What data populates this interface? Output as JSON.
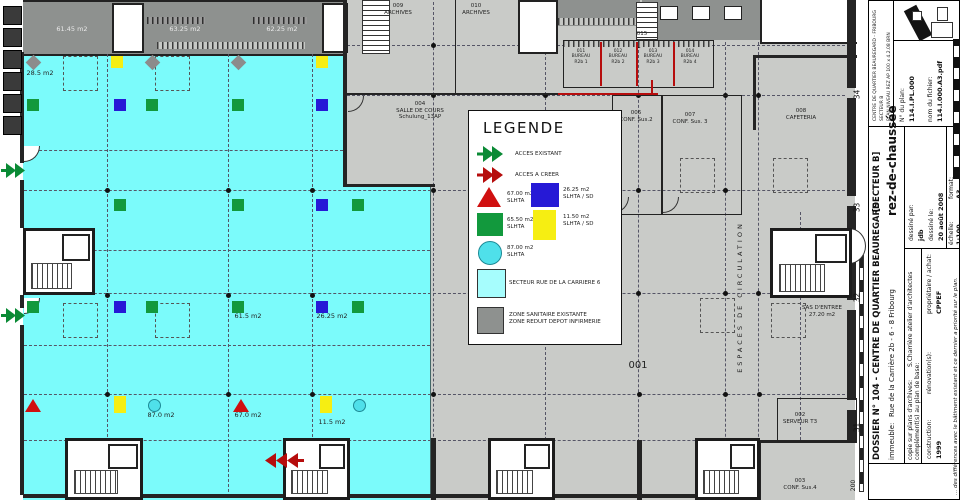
{
  "colors": {
    "floor_gray": "#c9cbc8",
    "zone_gray": "#8e918f",
    "sector_cyan": "#7bfbfb",
    "sector_legend": "#a6fdfd",
    "marker_green": "#12993d",
    "marker_blue": "#2619d6",
    "marker_yellow": "#f6ee12",
    "marker_red": "#d01010",
    "marker_cyan": "#4fe0ea",
    "acces_existant_green": "#0a8a35",
    "acces_creer_red": "#b60d0d"
  },
  "legend": {
    "title": "LEGENDE",
    "acces_existant": "ACCES EXISTANT",
    "acces_creer": "ACCES A CREER",
    "tri_l": "67.00 m2\nSLHTA",
    "blue_l": "26.25 m2\nSLHTA / SD",
    "green_l": "65.50 m2\nSLHTA",
    "yellow_l": "11.50 m2\nSLHTA / SD",
    "circle_l": "87.00 m2\nSLHTA",
    "sector_l": "SECTEUR RUE DE LA CARRIERE 6",
    "sanitaire_l": "ZON​E SANITAIRE EXISTANTE\nZONE REDUIT DEPOT INFIRMERIE"
  },
  "plan": {
    "labels": [
      {
        "text": "61.45 m2",
        "x": 72,
        "y": 26,
        "cls": "lt"
      },
      {
        "text": "63.25 m2",
        "x": 185,
        "y": 26,
        "cls": "lt"
      },
      {
        "text": "62.25 m2",
        "x": 282,
        "y": 26,
        "cls": "lt"
      },
      {
        "text": "28.5 m2",
        "x": 40,
        "y": 70,
        "cls": "sm"
      },
      {
        "text": "009\nARCHIVES",
        "x": 398,
        "y": 3,
        "cls": "xs"
      },
      {
        "text": "010\nARCHIVES",
        "x": 476,
        "y": 3,
        "cls": "xs"
      },
      {
        "text": "004\nSALLE DE COURS\nSchulung_13AP",
        "x": 420,
        "y": 101,
        "cls": "xs"
      },
      {
        "text": "015",
        "x": 642,
        "y": 31,
        "cls": "xs"
      },
      {
        "text": "011\nBUREAU\nR2b 1",
        "x": 581,
        "y": 49,
        "cls": "xxs"
      },
      {
        "text": "012\nBUREAU\nR2b 2",
        "x": 618,
        "y": 49,
        "cls": "xxs"
      },
      {
        "text": "013\nBUREAU\nR2b 3",
        "x": 653,
        "y": 49,
        "cls": "xxs"
      },
      {
        "text": "014\nBUREAU\nR2b 4",
        "x": 690,
        "y": 49,
        "cls": "xxs"
      },
      {
        "text": "006\nCONF. Sus.2",
        "x": 636,
        "y": 110,
        "cls": "xs"
      },
      {
        "text": "007\nCONF. Sus. 3",
        "x": 690,
        "y": 112,
        "cls": "xs"
      },
      {
        "text": "008\nCAFETERIA",
        "x": 801,
        "y": 108,
        "cls": "xs"
      },
      {
        "text": "001",
        "x": 638,
        "y": 360,
        "cls": "md"
      },
      {
        "text": "61.5 m2",
        "x": 248,
        "y": 313,
        "cls": "sm"
      },
      {
        "text": "26.25 m2",
        "x": 332,
        "y": 313,
        "cls": "sm"
      },
      {
        "text": "87.0 m2",
        "x": 161,
        "y": 412,
        "cls": "sm"
      },
      {
        "text": "67.0 m2",
        "x": 248,
        "y": 412,
        "cls": "sm"
      },
      {
        "text": "11.5 m2",
        "x": 332,
        "y": 419,
        "cls": "sm"
      },
      {
        "text": "SAS D'ENTREE\n27.20 m2",
        "x": 822,
        "y": 305,
        "cls": "xs"
      },
      {
        "text": "002\nSERVEUR T3",
        "x": 800,
        "y": 412,
        "cls": "xs"
      },
      {
        "text": "003\nCONF. Sus.4",
        "x": 800,
        "y": 478,
        "cls": "xs"
      },
      {
        "text": "ESPACES DE CIRCULATION",
        "x": 741,
        "y": 297,
        "cls": "vert"
      }
    ],
    "markers": [
      {
        "s": "d",
        "x": 33,
        "y": 62
      },
      {
        "s": "y",
        "x": 117,
        "y": 62
      },
      {
        "s": "d",
        "x": 152,
        "y": 62
      },
      {
        "s": "d",
        "x": 238,
        "y": 62
      },
      {
        "s": "y",
        "x": 322,
        "y": 62
      },
      {
        "s": "g",
        "x": 33,
        "y": 105
      },
      {
        "s": "b",
        "x": 120,
        "y": 105
      },
      {
        "s": "g",
        "x": 152,
        "y": 105
      },
      {
        "s": "g",
        "x": 238,
        "y": 105
      },
      {
        "s": "b",
        "x": 322,
        "y": 105
      },
      {
        "s": "g",
        "x": 120,
        "y": 205
      },
      {
        "s": "g",
        "x": 238,
        "y": 205
      },
      {
        "s": "b",
        "x": 322,
        "y": 205
      },
      {
        "s": "g",
        "x": 358,
        "y": 205
      },
      {
        "s": "g",
        "x": 33,
        "y": 307
      },
      {
        "s": "b",
        "x": 120,
        "y": 307
      },
      {
        "s": "g",
        "x": 152,
        "y": 307
      },
      {
        "s": "g",
        "x": 238,
        "y": 307
      },
      {
        "s": "b",
        "x": 322,
        "y": 307
      },
      {
        "s": "g",
        "x": 358,
        "y": 307
      },
      {
        "s": "t",
        "x": 33,
        "y": 405
      },
      {
        "s": "y2",
        "x": 120,
        "y": 405
      },
      {
        "s": "c",
        "x": 154,
        "y": 405
      },
      {
        "s": "t",
        "x": 241,
        "y": 405
      },
      {
        "s": "y2",
        "x": 326,
        "y": 405
      },
      {
        "s": "c",
        "x": 359,
        "y": 405
      }
    ],
    "arrows": [
      {
        "type": "acces-existant",
        "x": 1,
        "y": 162,
        "dir": "right"
      },
      {
        "type": "acces-existant",
        "x": 1,
        "y": 307,
        "dir": "right"
      },
      {
        "type": "acces-a-creer",
        "x": 264,
        "y": 452,
        "dir": "left"
      }
    ],
    "grid_labels": [
      {
        "label": "34",
        "y": 90
      },
      {
        "label": "33",
        "y": 203
      },
      {
        "label": "32",
        "y": 293
      },
      {
        "label": "31",
        "y": 423
      }
    ]
  },
  "title_block": {
    "project_lines": [
      "CENTRE DE QUARTIER BEAUREGARD - FRIBOURG",
      "SECTEUR B",
      "PLAN NIVEAU REZ AP    100 x 4.2.08 BRN"
    ],
    "dossier": "DOSSIER N°  104 - CENTRE DE QUARTIER BEAUREGARD",
    "sector": "[SECTEUR B]",
    "floor": "rez-de-chaussée",
    "immeuble_label": "immeuble:",
    "immeuble": "Rue de la Carrière 2b - 6 - 8  Fribourg",
    "copie_label": "copie sur plans d'archives:",
    "copie": "S.Charrière atelier d'architectes",
    "complement_label": "complément(s) au plan de base:",
    "construction_label": "construction:",
    "construction": "1999",
    "renovation_label": "rénovation(s):",
    "proprietaire_label": "propriétaire / achat:",
    "proprietaire": "CPPEF",
    "dessine_par_label": "dessiné par:",
    "dessine_par": "jdb",
    "dessine_le_label": "dessiné le:",
    "dessine_le": "20 août 2008",
    "echelle_label": "échelle:",
    "echelle": "1:100",
    "format_label": "format:",
    "format": "A3",
    "plan_no_label": "N° du plan:",
    "plan_no": "114.I.PL.000",
    "file_label": "nom du fichier:",
    "file": "114.I.000.A3.pdf",
    "footnote": "... des différences avec le bâtiment existant et ce dernier a priorité sur le plan.",
    "scale_note": "200"
  }
}
